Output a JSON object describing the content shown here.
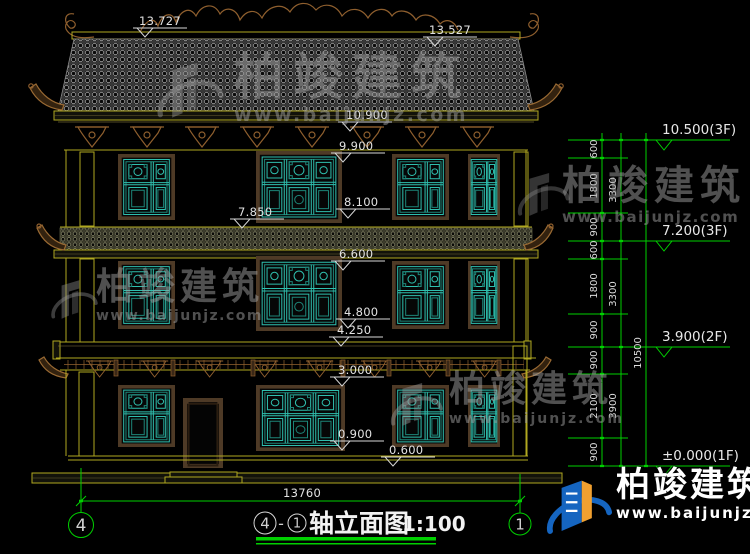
{
  "watermark": {
    "brand": "柏竣建筑",
    "url": "www.baijunjz.com"
  },
  "drawing_title": {
    "axis_start": "4",
    "axis_end": "1",
    "name": "轴立面图",
    "separator": "-",
    "scale": "1:100"
  },
  "axis_bubbles": {
    "left": "4",
    "right": "1"
  },
  "dimensions": {
    "ridge_left": "13.727",
    "ridge_right": "13.527",
    "levels": [
      "10.900",
      "9.900",
      "8.100",
      "7.850",
      "6.600",
      "4.800",
      "4.250",
      "3.000",
      "0.900",
      "0.600"
    ],
    "total_width": "13760",
    "right_column": {
      "segments_inner": [
        "600",
        "1800",
        "900",
        "600",
        "1800",
        "900",
        "900",
        "2100",
        "900"
      ],
      "segments_middle": [
        "3300",
        "3300",
        "3900"
      ],
      "total": "10500",
      "floor_elevations": [
        "10.500(3F)",
        "7.200(3F)",
        "3.900(2F)",
        "±0.000(1F)"
      ]
    }
  },
  "colors": {
    "background": "#000000",
    "dimension_green": "#00d000",
    "cad_olive": "#b0a820",
    "ornament_brown": "#8f5f2e",
    "window_teal": "#2fbfae",
    "logo_blue": "#1565c0",
    "logo_orange": "#f0a030"
  }
}
